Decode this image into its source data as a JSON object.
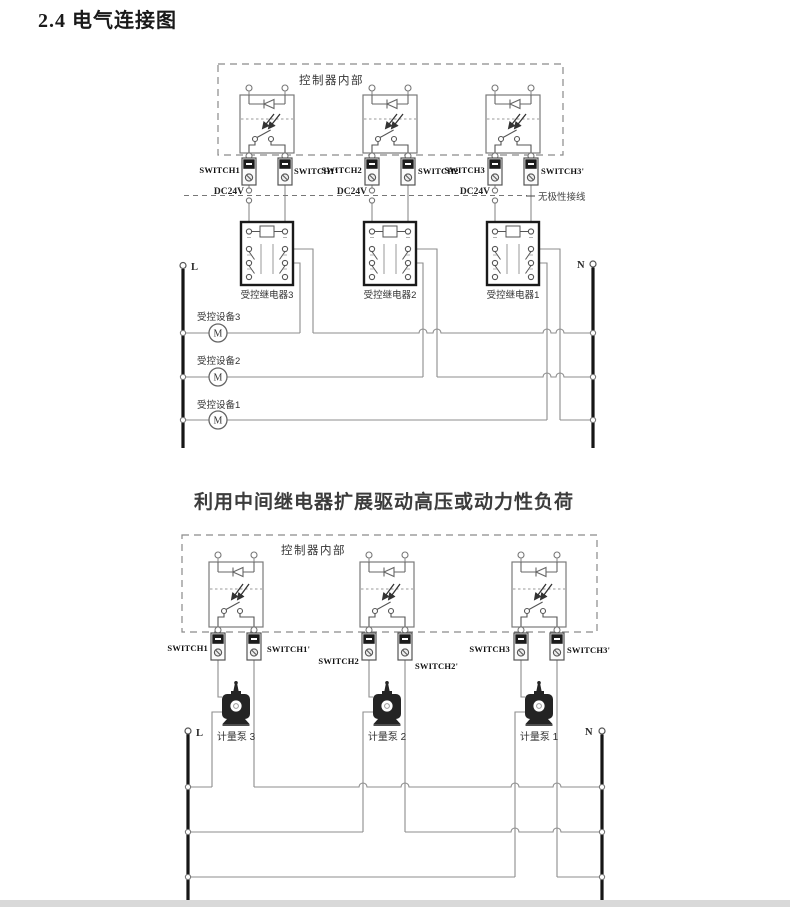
{
  "page": {
    "title": "2.4 电气连接图"
  },
  "caption": "利用中间继电器扩展驱动高压或动力性负荷",
  "diagram_top": {
    "controller_label": "控制器内部",
    "dc24v": "DC24V",
    "polarity_note": "无极性接线",
    "switches": [
      "SWITCH1",
      "SWITCH1'",
      "SWITCH2",
      "SWITCH2'",
      "SWITCH3",
      "SWITCH3'"
    ],
    "relays": [
      "受控继电器3",
      "受控继电器2",
      "受控继电器1"
    ],
    "devices": [
      "受控设备3",
      "受控设备2",
      "受控设备1"
    ],
    "motor_letter": "M",
    "phase_left": "L",
    "neutral_right": "N"
  },
  "diagram_bottom": {
    "controller_label": "控制器内部",
    "switches": [
      "SWITCH1",
      "SWITCH1'",
      "SWITCH2",
      "SWITCH2'",
      "SWITCH3",
      "SWITCH3'"
    ],
    "pumps": [
      "计量泵 3",
      "计量泵 2",
      "计量泵 1"
    ],
    "phase_left": "L",
    "neutral_right": "N"
  }
}
